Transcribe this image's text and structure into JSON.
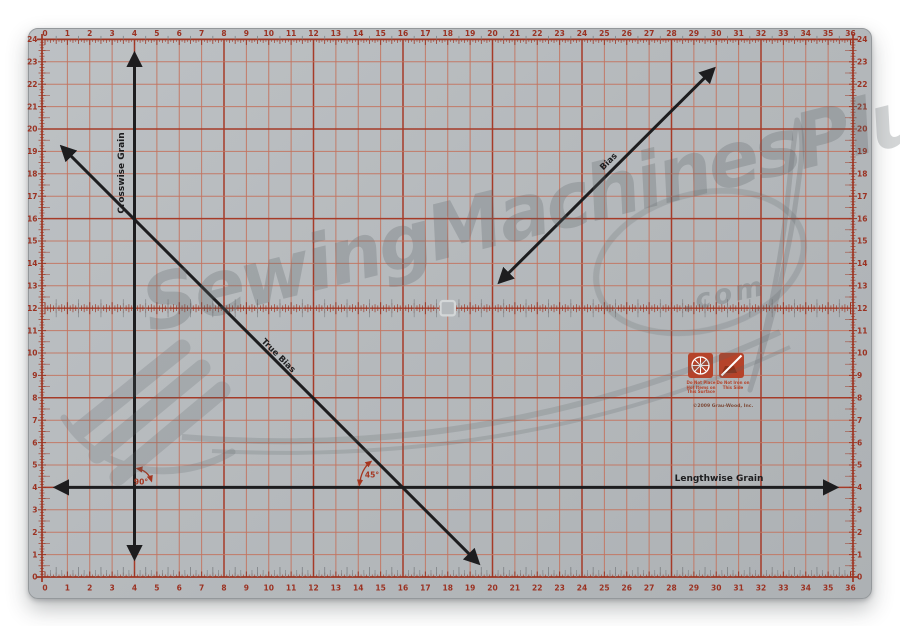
{
  "subject": "rotary cutting mat product photo",
  "mat": {
    "x_min": 0,
    "x_max": 36,
    "y_min": 0,
    "y_max": 24,
    "major_every": 4
  },
  "colors": {
    "mat_gray": "#b5b9bc",
    "grid_minor": "#c4735e",
    "grid_major": "#a63b28",
    "ruler_edge": "#9e3623",
    "number_red": "#9b3222",
    "tick_gray": "#83878a",
    "black_line": "#1d1d1f",
    "annotation_red": "#a5351f",
    "logo_orange": "#b5432a",
    "square_marker": "#d4d7d8",
    "watermark_gray": "#5c6367"
  },
  "arrows": {
    "crosswise": {
      "label": "Crosswise Grain",
      "x": 4
    },
    "lengthwise": {
      "label": "Lengthwise Grain",
      "y": 4
    },
    "true_bias": {
      "label": "True Bias",
      "from": [
        0.54,
        19.46
      ],
      "to": [
        19.58,
        0.36
      ]
    },
    "bias": {
      "label": "Bias",
      "from": [
        20.1,
        12.95
      ],
      "to": [
        30.1,
        22.9
      ]
    }
  },
  "labels": {
    "angle_90": "90°",
    "angle_45": "45°"
  },
  "watermark": {
    "text": "SewingMachinesPlus",
    "suffix": ".com"
  },
  "annotations": {
    "warning_left": [
      "Do Not Place",
      "Hot Items on",
      "This Surface"
    ],
    "warning_right": [
      "Do Not Iron on",
      "This Side"
    ],
    "copyright": "©2009 Grau-Wood, Inc."
  }
}
